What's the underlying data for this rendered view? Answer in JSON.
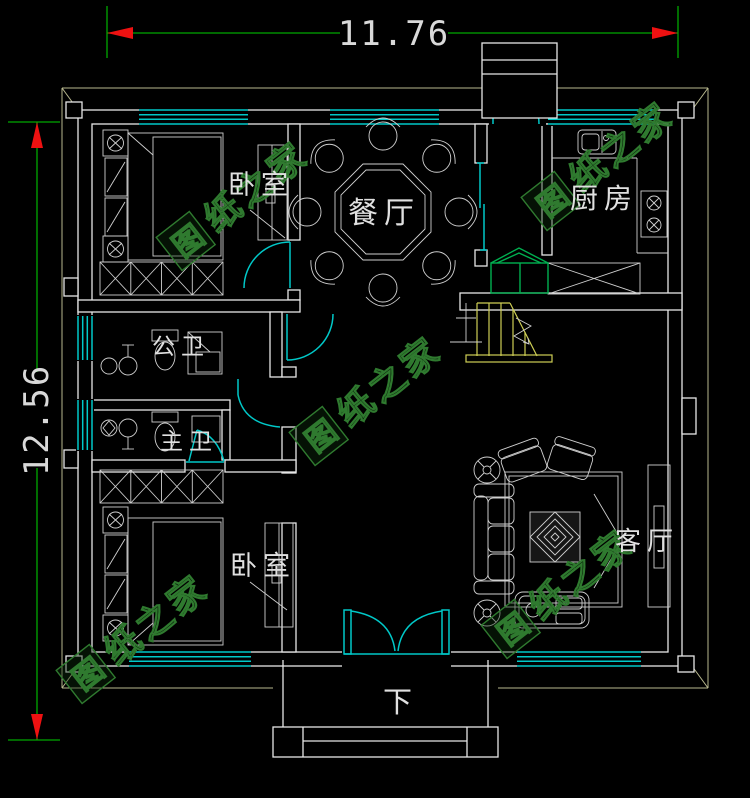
{
  "dimensions": {
    "width": "11.76",
    "height": "12.56"
  },
  "rooms": {
    "bedroom_top": {
      "label": "卧室"
    },
    "dining": {
      "label": "餐厅"
    },
    "kitchen": {
      "label": "厨房"
    },
    "guest_bath": {
      "label": "公卫"
    },
    "master_bath": {
      "label": "主卫"
    },
    "bedroom_bottom": {
      "label": "卧室"
    },
    "living": {
      "label": "客厅"
    },
    "entry_step": {
      "label": "下"
    }
  },
  "watermark": {
    "logo": "图",
    "text": "纸之家",
    "full": "图纸之家"
  },
  "colors": {
    "background": "#000000",
    "wall": "#e6e6e6",
    "glazing": "#00c8c8",
    "dimension": "#00a800",
    "arrow": "#ee1111",
    "stair": "#cfcf55",
    "eave": "#b8b88e",
    "watermark": "#2f7a2f",
    "accent": "#00b050",
    "label": "#e0e0e0"
  }
}
